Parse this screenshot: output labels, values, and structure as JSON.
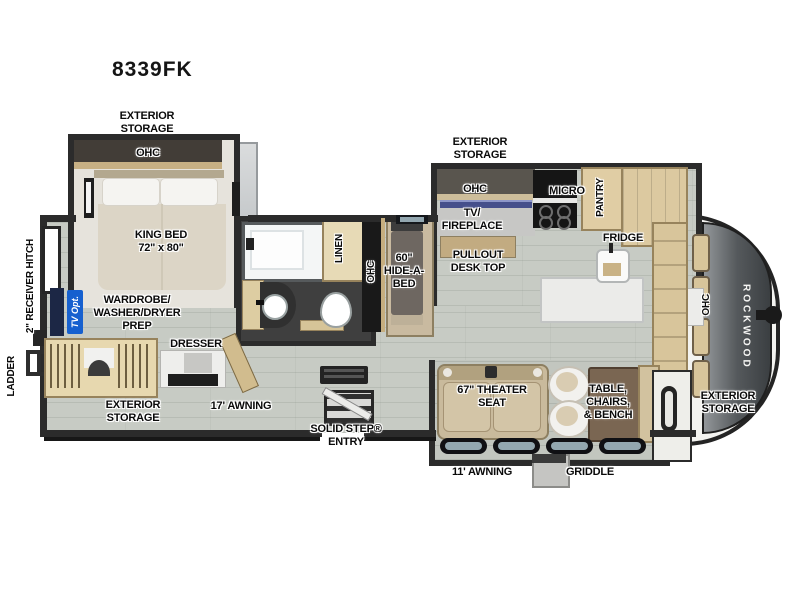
{
  "title": "8339FK",
  "brand": "ROCKWOOD",
  "labels": {
    "ext_storage": "EXTERIOR\nSTORAGE",
    "ohc": "OHC",
    "king_bed": "KING BED\n72\" x 80\"",
    "receiver_hitch": "2\" RECEIVER HITCH",
    "ladder": "LADDER",
    "tv_opt": "TV Opt.",
    "wardrobe_prep": "WARDROBE/\nWASHER/DRYER\nPREP",
    "dresser": "DRESSER",
    "awning_17": "17' AWNING",
    "solid_step": "SOLID STEP®\nENTRY",
    "linen": "LINEN",
    "hide_a_bed": "60\"\nHIDE-A-\nBED",
    "tv_fireplace": "TV/\nFIREPLACE",
    "pullout_desk": "PULLOUT\nDESK TOP",
    "micro": "MICRO",
    "pantry": "PANTRY",
    "fridge": "FRIDGE",
    "theater_seat": "67\" THEATER\nSEAT",
    "table_chairs": "TABLE,\nCHAIRS,\n& BENCH",
    "awning_11": "11' AWNING",
    "griddle": "GRIDDLE"
  },
  "colors": {
    "wall": "#2b2b2b",
    "floor_wood": "#c7cbc4",
    "cabinet_tan": "#d8c59b",
    "accent_blue": "#1660cf",
    "nose_gray": "#55595c"
  }
}
